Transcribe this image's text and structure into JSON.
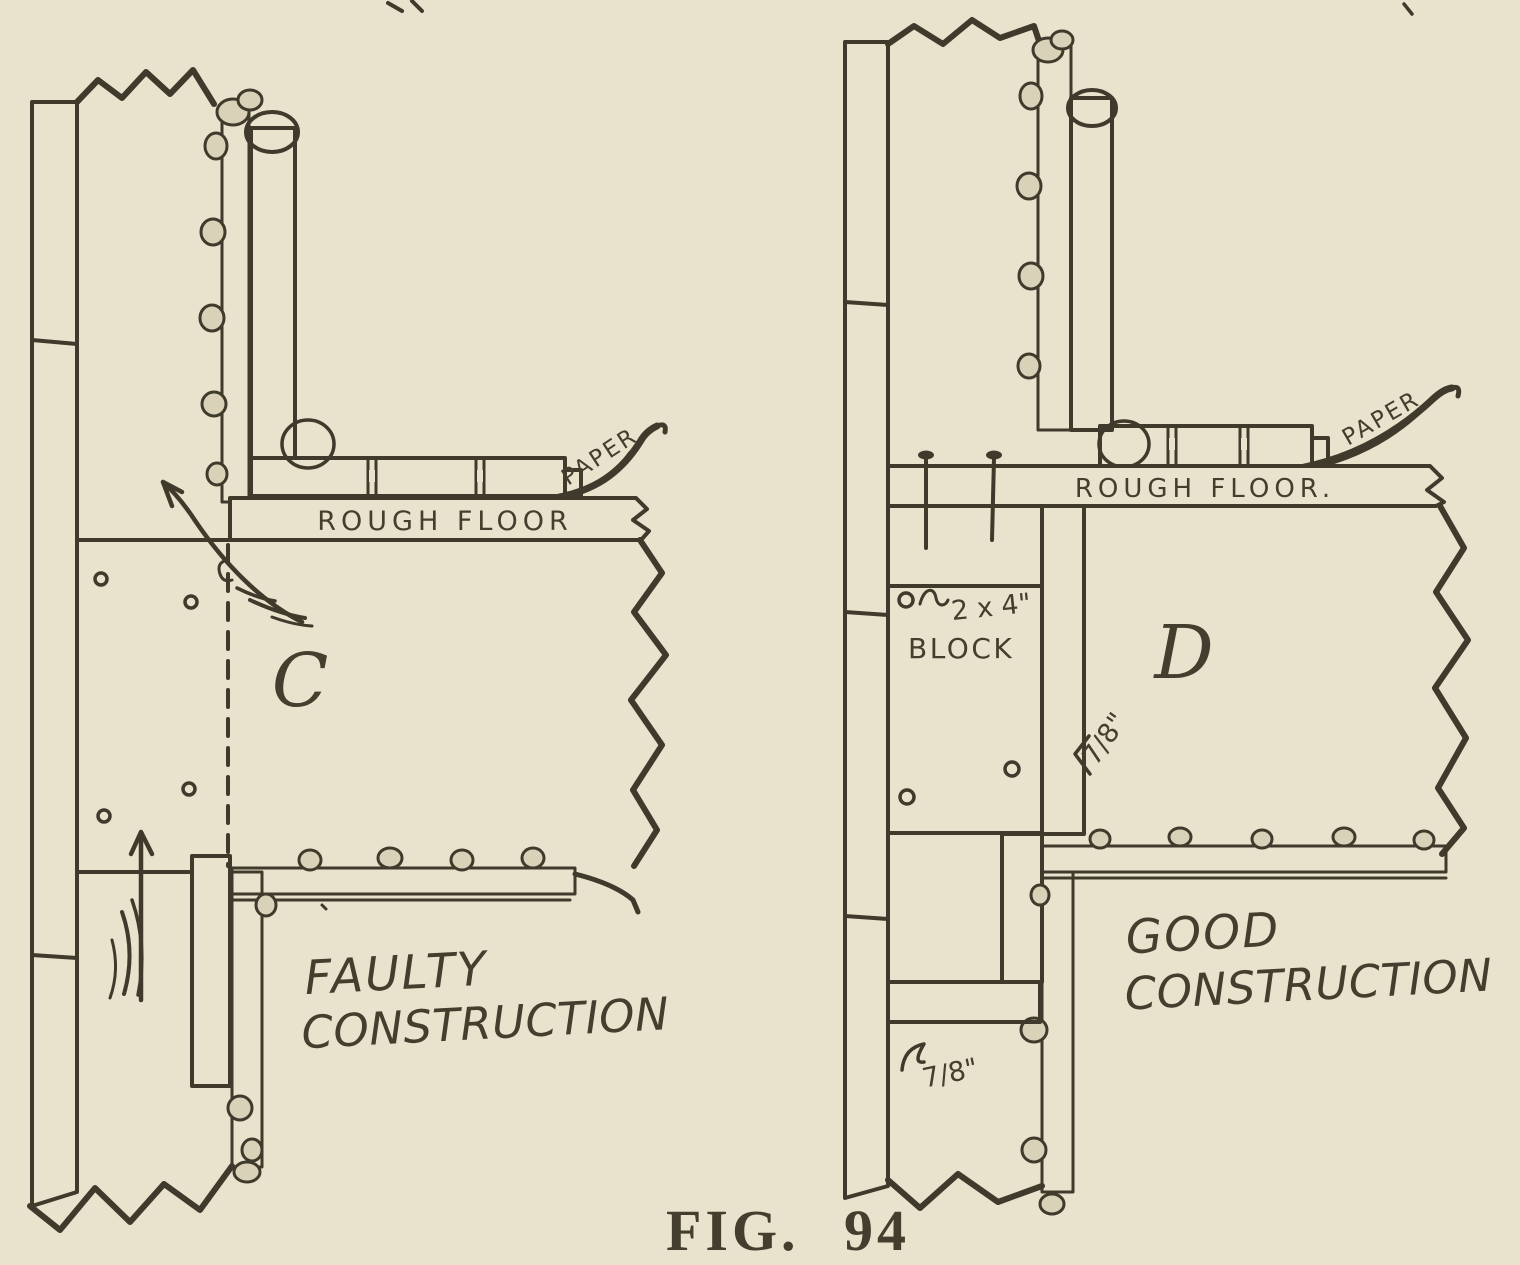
{
  "figure": {
    "caption": "FIG. 94",
    "colors": {
      "paper": "#e9e2cc",
      "ink": "#3f3a2c"
    },
    "left_panel": {
      "letter": "C",
      "caption": [
        "FAULTY",
        "CONSTRUCTION"
      ],
      "rough_floor_label": "ROUGH FLOOR",
      "paper_label": "PAPER"
    },
    "right_panel": {
      "letter": "D",
      "caption": [
        "GOOD",
        "CONSTRUCTION"
      ],
      "rough_floor_label": "ROUGH FLOOR.",
      "paper_label": "PAPER",
      "block_dim_label": "2 x 4\"",
      "block_label": "BLOCK",
      "plaster_thickness_upper": "7/8\"",
      "plaster_thickness_lower": "7/8\""
    }
  }
}
